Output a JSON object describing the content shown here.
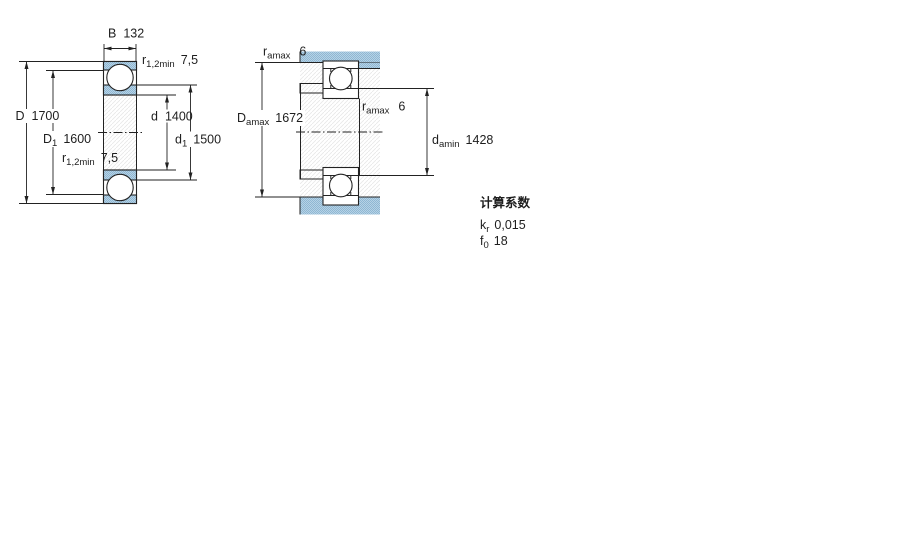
{
  "figure": {
    "type": "deep-groove-ball-bearing-technical-drawing",
    "left_view_dims": {
      "B": {
        "sym": "B",
        "val": "132"
      },
      "r12_top": {
        "sym": "r",
        "sub": "1,2min",
        "val": "7,5"
      },
      "D": {
        "sym": "D",
        "val": "1700"
      },
      "D1": {
        "sym": "D",
        "sub": "1",
        "val": "1600"
      },
      "d": {
        "sym": "d",
        "val": "1400"
      },
      "d1": {
        "sym": "d",
        "sub": "1",
        "val": "1500"
      },
      "r12_bottom": {
        "sym": "r",
        "sub": "1,2min",
        "val": "7,5"
      }
    },
    "right_view_dims": {
      "ra_top": {
        "sym": "r",
        "sub": "amax",
        "val": "6"
      },
      "Da": {
        "sym": "D",
        "sub": "amax",
        "val": "1672"
      },
      "ra_mid": {
        "sym": "r",
        "sub": "amax",
        "val": "6"
      },
      "da": {
        "sym": "d",
        "sub": "amin",
        "val": "1428"
      }
    },
    "calculation_factors": {
      "heading": "计算系数",
      "kr": {
        "sym": "k",
        "sub": "r",
        "val": "0,015"
      },
      "f0": {
        "sym": "f",
        "sub": "0",
        "val": "18"
      }
    },
    "colors": {
      "steel_light": "#b6d2e5",
      "steel_dark": "#8fb7d3",
      "line": "#222222",
      "hatch": "#e8e8e8",
      "background": "#ffffff"
    }
  }
}
